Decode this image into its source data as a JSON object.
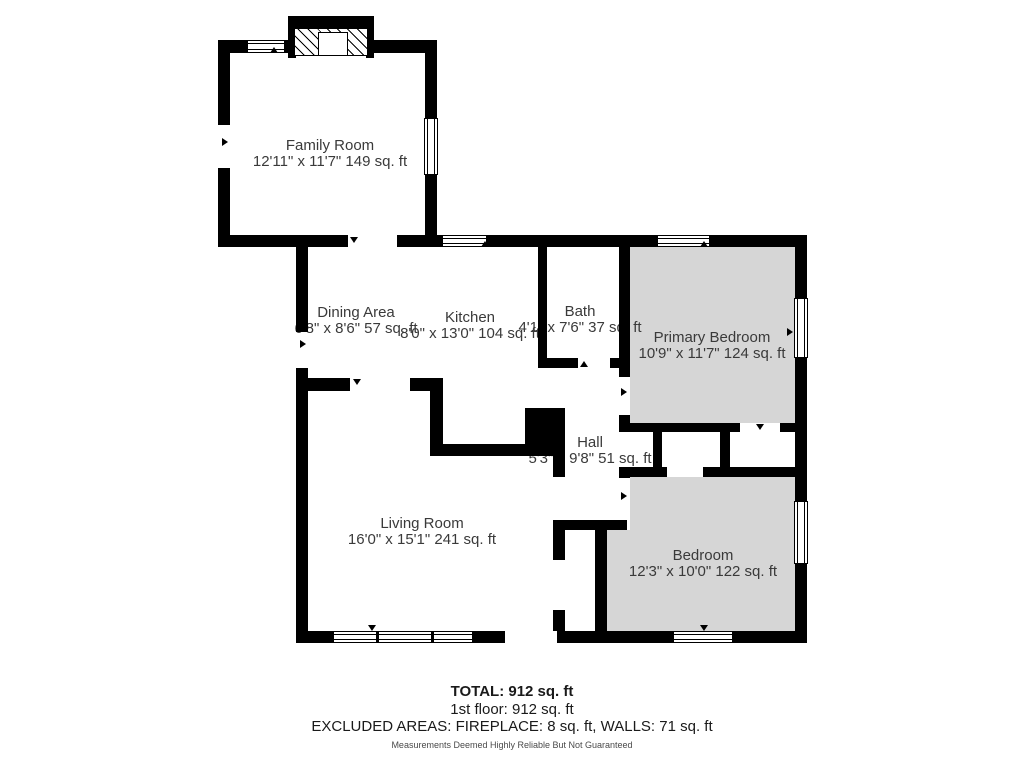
{
  "plan": {
    "type": "floor-plan",
    "rooms": [
      {
        "id": "family-room",
        "name": "Family Room",
        "dims": "12'11\" x 11'7\" 149 sq. ft"
      },
      {
        "id": "dining-area",
        "name": "Dining Area",
        "dims": "6'8\" x 8'6\" 57 sq. ft"
      },
      {
        "id": "kitchen",
        "name": "Kitchen",
        "dims": "8'0\" x 13'0\" 104 sq. ft"
      },
      {
        "id": "bath",
        "name": "Bath",
        "dims": "4'1\" x 7'6\" 37 sq. ft"
      },
      {
        "id": "primary-bedroom",
        "name": "Primary Bedroom",
        "dims": "10'9\" x 11'7\" 124 sq. ft"
      },
      {
        "id": "hall",
        "name": "Hall",
        "dims": "5'3\" x 9'8\" 51 sq. ft"
      },
      {
        "id": "living-room",
        "name": "Living Room",
        "dims": "16'0\" x 15'1\" 241 sq. ft"
      },
      {
        "id": "bedroom",
        "name": "Bedroom",
        "dims": "12'3\" x 10'0\" 122 sq. ft"
      }
    ],
    "features": {
      "fireplace_icon": "hatched fireplace symbol on top wall of Family Room",
      "shaded_rooms": [
        "Primary Bedroom",
        "Bedroom"
      ],
      "window_icon": "white double-line window symbol",
      "door_arrow_icon": "small black triangle marking openings"
    },
    "colors": {
      "wall": "#000000",
      "room_fill_shaded": "#d6d6d6",
      "background": "#ffffff",
      "label_text": "#3a3a3a"
    }
  },
  "summary": {
    "total": "TOTAL: 912 sq. ft",
    "floor": "1st floor: 912 sq. ft",
    "excluded": "EXCLUDED AREAS: FIREPLACE: 8 sq. ft, WALLS: 71 sq. ft",
    "disclaimer": "Measurements Deemed Highly Reliable But Not Guaranteed"
  }
}
